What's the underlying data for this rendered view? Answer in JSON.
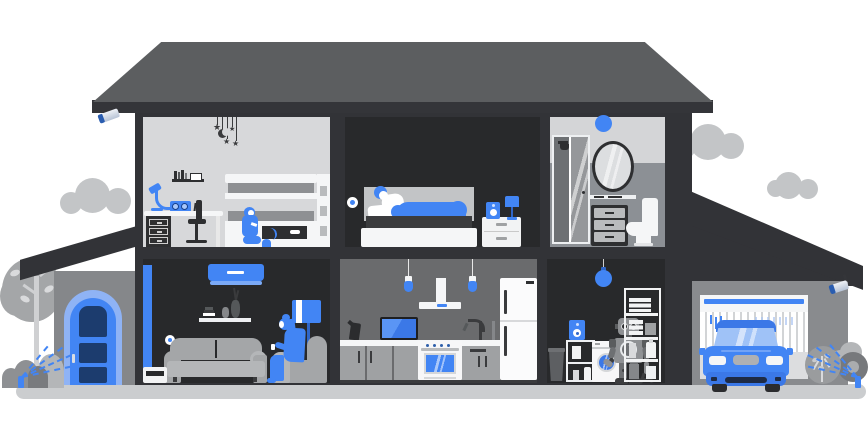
{
  "scene": {
    "name": "smart-home-cutaway-illustration",
    "background": "#ffffff",
    "glyphs": {
      "star": "★"
    },
    "colors": {
      "blue": "#4285f4",
      "blue_dark": "#2f66c9",
      "blue_mid": "#3b78e7",
      "blue_light": "#8fb3f5",
      "blue_pale": "#9fc2f7",
      "blue_soft": "#a8c7fa",
      "navy": "#1c3c6e",
      "navy_deep": "#1e2b45",
      "wall": "#323337",
      "wall_band": "#343539",
      "roof": "#5c5e60",
      "room_dark": "#28292b",
      "room_light": "#d7d8da",
      "bath_upper": "#d4d5d7",
      "bath_lower": "#8c9095",
      "kitchen_wall": "#6a6b6d",
      "garage_wall": "#898b8e",
      "porch_wall": "#85878a",
      "gray_1": "#a4a6a8",
      "gray_2": "#b4b6b8",
      "gray_3": "#c3c5c7",
      "gray_4": "#8e9093",
      "gray_5": "#5d5f62",
      "dark_1": "#2e2f31",
      "dark_2": "#3a3b3d",
      "white_1": "#f5f6f7",
      "white_2": "#eef0f2",
      "ground": "#cbcdcf",
      "headboard": "#c2c4c6",
      "mattress": "#3b3c3e",
      "cab": "#9fa1a3",
      "seam": "#d5d7d9",
      "robot": "#8f9194",
      "robot_dark": "#6e7073",
      "robot_darker": "#5a5c5e",
      "feet": "#3c3d3f",
      "metal_hi": "#eef1f6",
      "metal_lo": "#b7c3d6"
    },
    "exterior": {
      "clouds": [
        "cloud-left",
        "cloud-right-large",
        "cloud-right-small"
      ],
      "security_cameras": [
        "left-eave-camera",
        "garage-eave-camera"
      ],
      "tree": "deciduous-tree",
      "front_door": {
        "state": "closed",
        "color": "#4285f4",
        "panel_color": "#1c3c6e"
      },
      "sprinklers": [
        "front-yard-sprinkler",
        "side-yard-sprinkler"
      ],
      "garage": {
        "door_state": "open",
        "car_color": "#4285f4"
      }
    },
    "rooms": [
      {
        "id": "kids-room",
        "floor": 2,
        "objects": [
          "hanging-mobile-stars-moon",
          "wall-shelf-books",
          "desk-lamp",
          "smart-radio",
          "desk-with-drawers",
          "office-chair",
          "bunk-bed",
          "child-playing",
          "cat"
        ]
      },
      {
        "id": "master-bedroom",
        "floor": 2,
        "objects": [
          "smart-wall-device",
          "bed",
          "sleeping-person",
          "smart-speaker",
          "table-lamp",
          "nightstand"
        ]
      },
      {
        "id": "bathroom",
        "floor": 2,
        "objects": [
          "smart-ceiling-light",
          "shower-cabin",
          "oval-mirror",
          "shelf",
          "dresser",
          "toilet"
        ]
      },
      {
        "id": "living-room",
        "floor": 1,
        "objects": [
          "air-conditioner",
          "curtain",
          "wall-shelf-vases",
          "smart-wall-device",
          "sofa",
          "armchair",
          "woman-reading-phone",
          "floor-lamp",
          "side-table"
        ]
      },
      {
        "id": "kitchen",
        "floor": 1,
        "objects": [
          "pendant-light",
          "pendant-light",
          "range-hood",
          "tv",
          "kettle",
          "faucet",
          "stove-oven",
          "cabinets",
          "fridge"
        ]
      },
      {
        "id": "laundry-room",
        "floor": 1,
        "objects": [
          "smart-pendant-light",
          "trash-can",
          "smart-speaker",
          "utility-cart",
          "washing-machine",
          "home-robot",
          "shelving-unit"
        ]
      }
    ]
  }
}
